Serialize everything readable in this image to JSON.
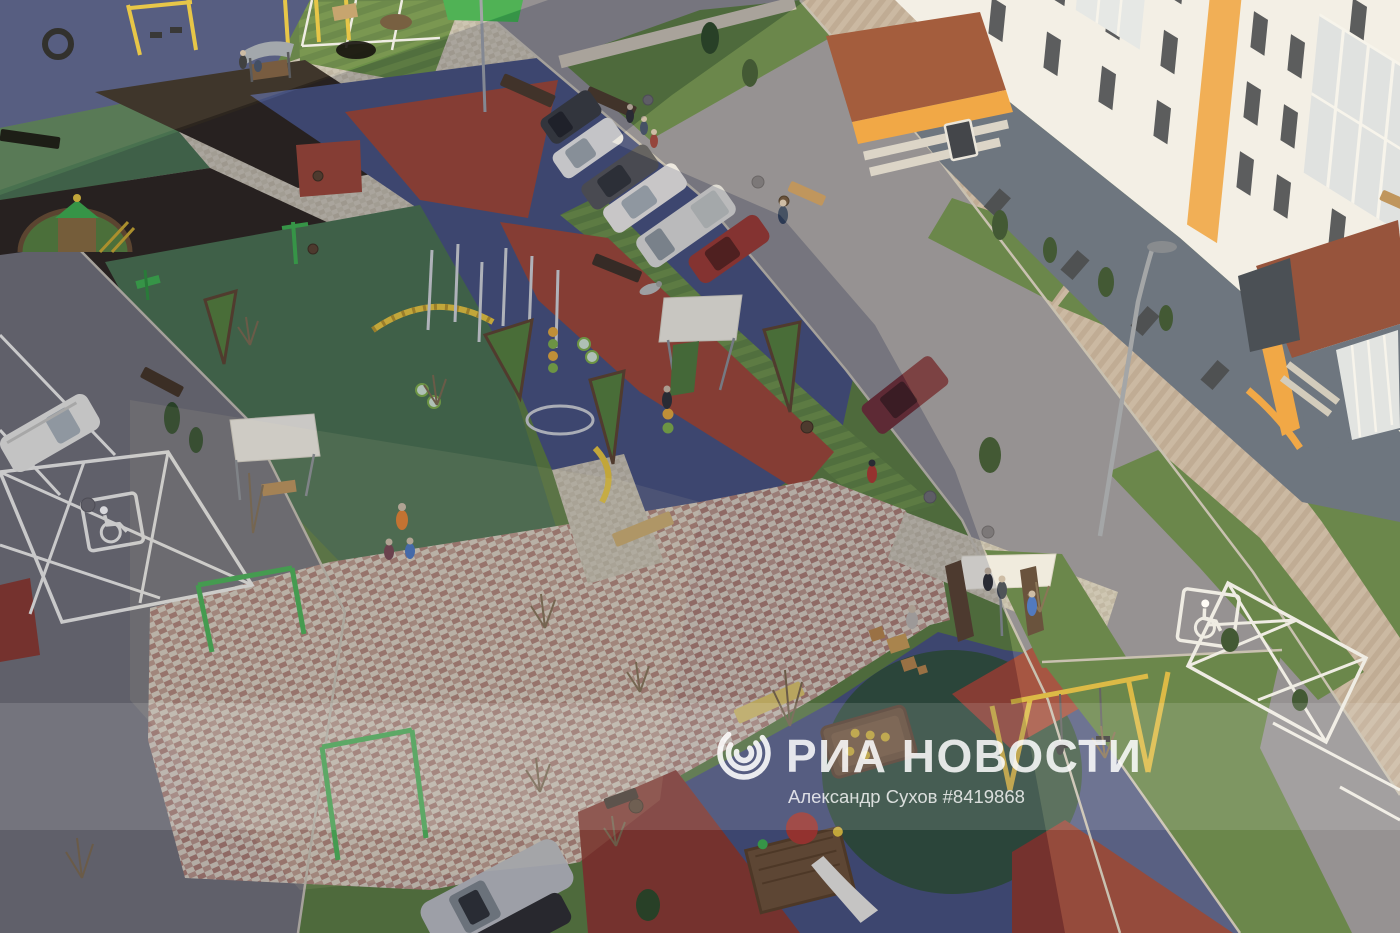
{
  "watermark": {
    "agency_name": "РИА НОВОСТИ",
    "credit_line": "Александр Сухов #8419868",
    "logo_icon": "ria-globe-arcs-icon"
  },
  "icons": {
    "accessible_parking": "wheelchair-icon"
  },
  "scene": {
    "description_labels": {
      "setting": "aerial-courtyard-playground",
      "building": "apartment-block-white-orange",
      "road_marking": "accessible-parking-crosshatch"
    }
  },
  "palette": {
    "grass": "#5b7d41",
    "asphalt": "#8b8a90",
    "asphalt_dark": "#717078",
    "rubber_blue": "#47527e",
    "rubber_green": "#49714f",
    "rubber_green_dark": "#32503e",
    "rubber_red": "#9c4737",
    "rubber_red_dark": "#8a3a30",
    "mulch": "#2d261f",
    "building_white": "#f2f1ec",
    "building_gray": "#5e6a7b",
    "window_dark": "#3c4149",
    "accent_orange": "#f0a23c",
    "roof_brown": "#9a4e32",
    "equip_yellow": "#e5c43f",
    "equip_green": "#3fae4e",
    "wood": "#6b5036",
    "white": "#ffffff"
  }
}
